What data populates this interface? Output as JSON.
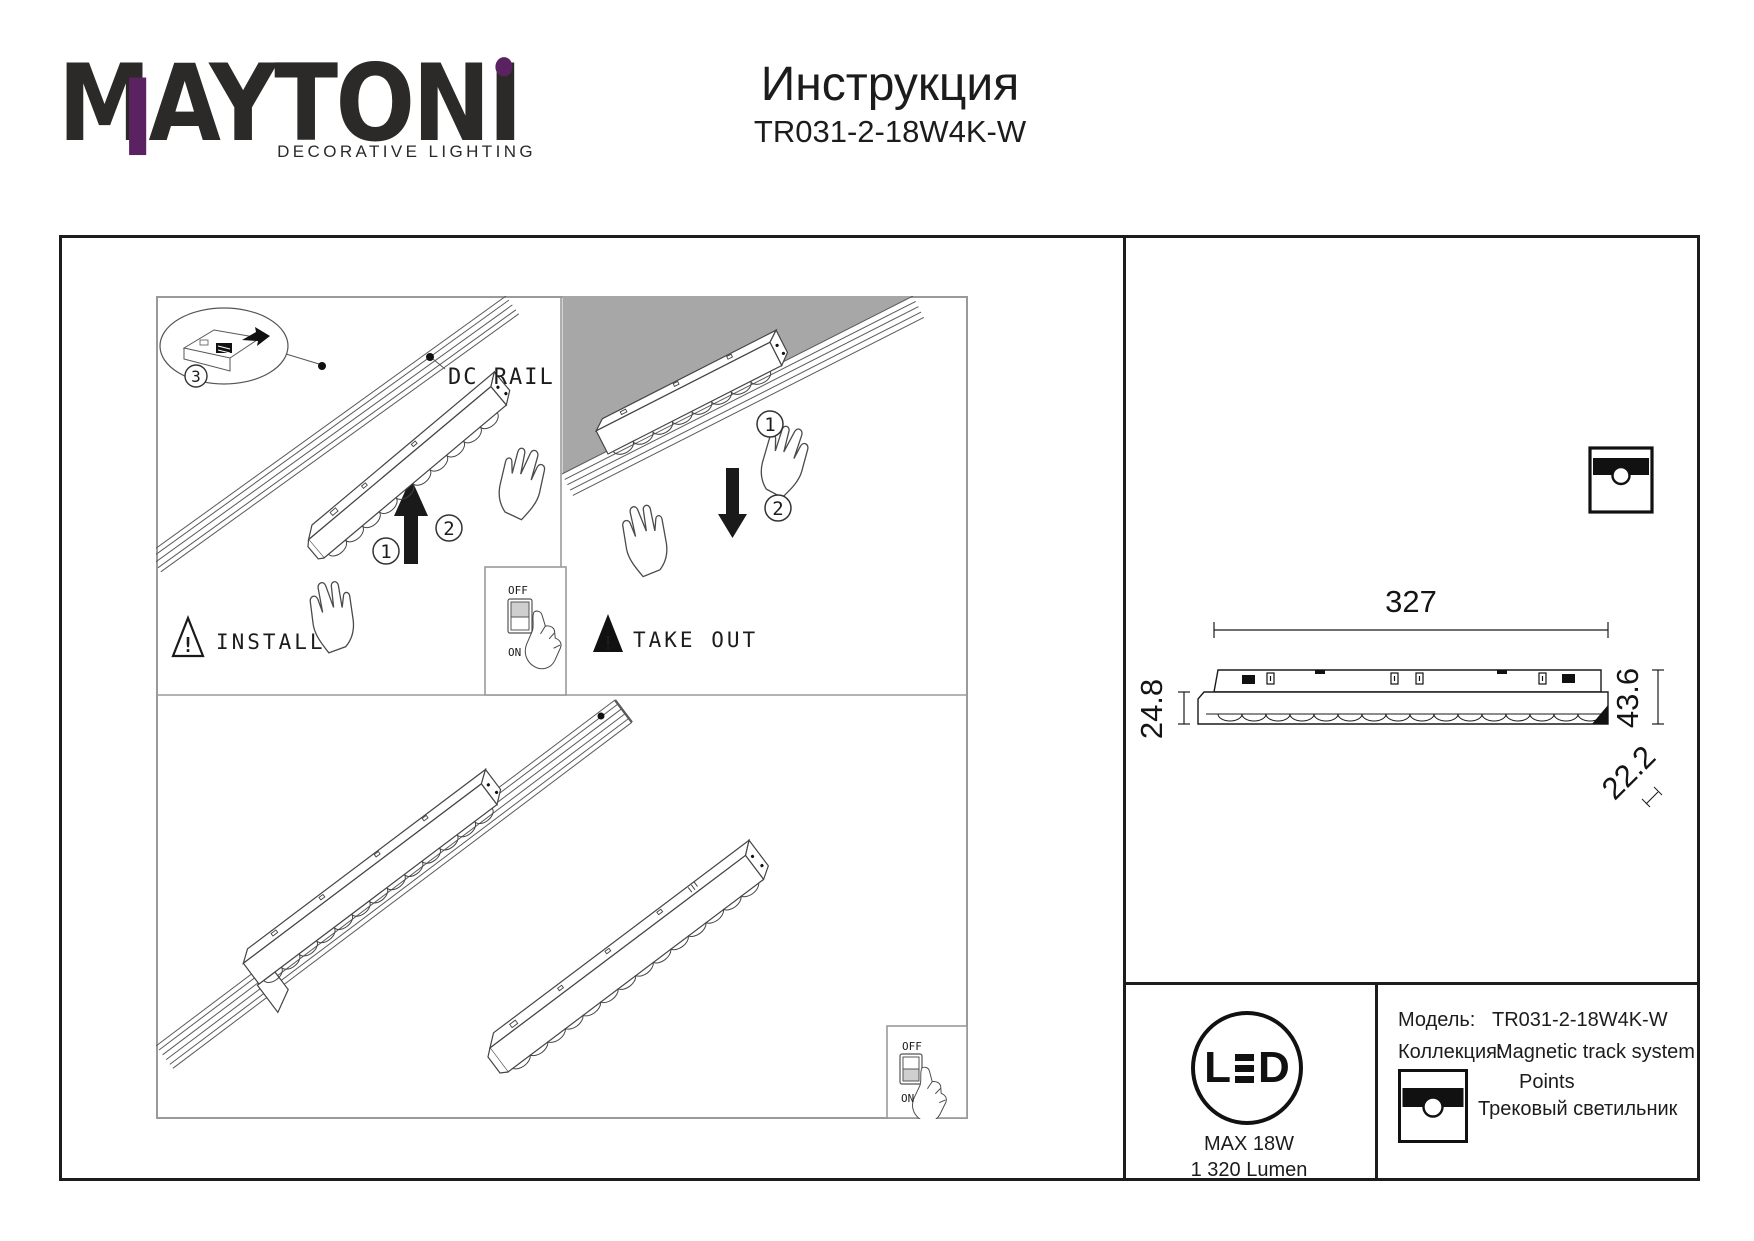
{
  "brand": {
    "logo": "MAYTONI",
    "tagline": "DECORATIVE LIGHTING",
    "accent_color": "#5b2261",
    "dark_color": "#2b2a29"
  },
  "header": {
    "title": "Инструкция",
    "model": "TR031-2-18W4K-W"
  },
  "figure": {
    "dc_rail_label": "DC RAIL",
    "install_label": "INSTALL",
    "take_out_label": "TAKE OUT",
    "warning_mark": "!",
    "switch": {
      "off": "OFF",
      "on": "ON"
    },
    "steps": {
      "one": "1",
      "two": "2",
      "three": "3"
    }
  },
  "dimensions": {
    "length": "327",
    "height_body": "24.8",
    "height_total": "43.6",
    "width": "22.2"
  },
  "spec": {
    "led_logo_l": "L",
    "led_logo_d": "D",
    "max_power": "MAX 18W",
    "luminous_flux": "1 320 Lumen",
    "rows": [
      {
        "label": "Модель:",
        "value": "TR031-2-18W4K-W"
      },
      {
        "label": "Коллекция:",
        "value": "Magnetic track system"
      }
    ],
    "collection_name": "Points",
    "product_type": "Трековый светильник"
  }
}
